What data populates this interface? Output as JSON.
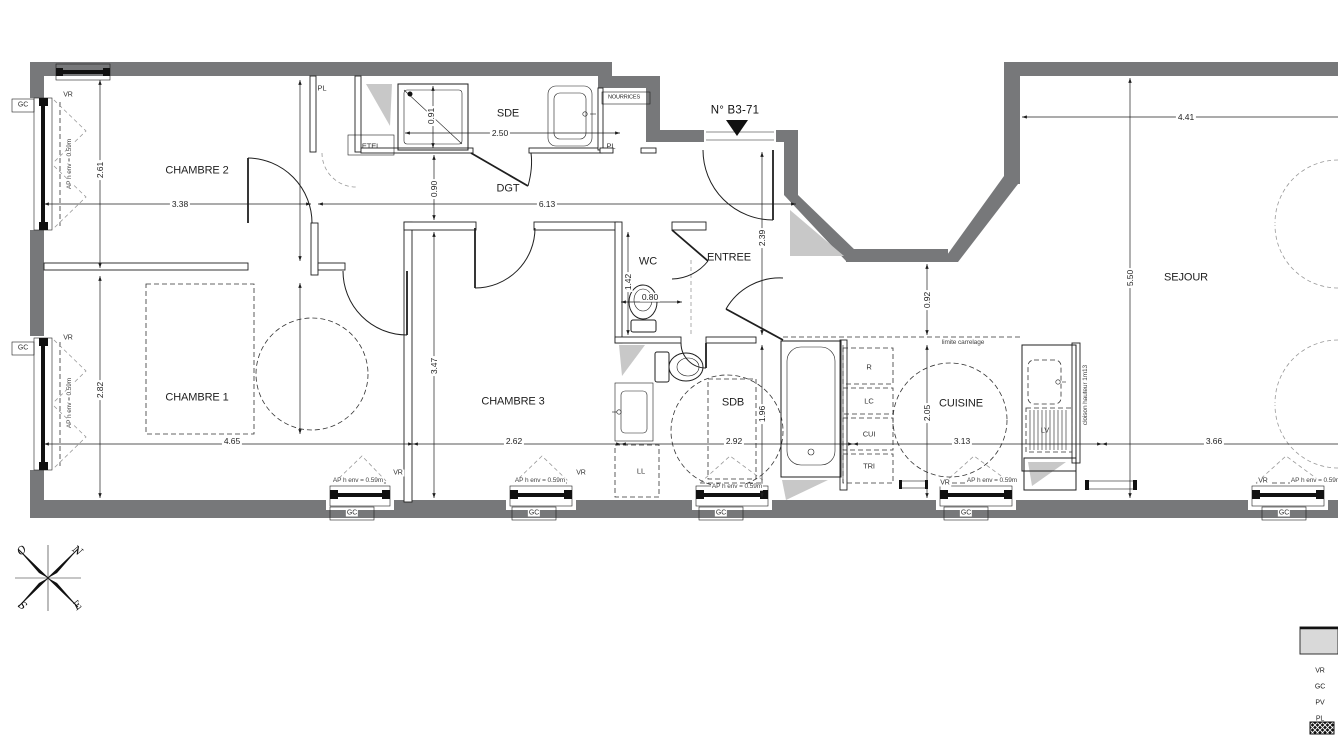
{
  "title": "N° B3-71",
  "rooms": {
    "chambre2": "CHAMBRE 2",
    "sde": "SDE",
    "dgt": "DGT",
    "wc": "WC",
    "entree": "ENTREE",
    "chambre1": "CHAMBRE 1",
    "chambre3": "CHAMBRE 3",
    "sdb": "SDB",
    "cuisine": "CUISINE",
    "sejour": "SEJOUR"
  },
  "dims": {
    "chambre2_w": "3.38",
    "chambre2_h": "2.61",
    "sde_w": "2.50",
    "shower_w": "0.91",
    "dgt_w": "0.90",
    "dgt_l": "6.13",
    "entree_h": "2.39",
    "wc_h": "1.42",
    "wc_w": "0.80",
    "recess_h": "0.92",
    "sejour_top_w": "4.41",
    "sejour_h": "5.50",
    "chambre1_h": "2.82",
    "chambre1_w": "4.65",
    "chambre3_h": "3.47",
    "chambre3_w": "2.62",
    "sdb_w": "2.92",
    "sdb_h": "1.96",
    "cuisine_h": "2.05",
    "cuisine_w": "3.13",
    "sejour_w": "3.66"
  },
  "annotations": {
    "pl": "PL",
    "etel": "ETEL",
    "nourrices": "NOURRICES",
    "limite_carrelage": "limite carrelage",
    "cloison": "cloison hauteur 1m13",
    "r": "R",
    "lc": "LC",
    "cui": "CUI",
    "tri": "TRI",
    "ll": "LL",
    "lv": "LV"
  },
  "windows": {
    "vr": "VR",
    "gc": "GC",
    "ap": "AP h env = 0.59m"
  },
  "legend": {
    "vr": "VR",
    "gc": "GC",
    "pv": "PV",
    "pl": "PL"
  },
  "compass": {
    "n": "N",
    "e": "E",
    "s": "S",
    "o": "O"
  },
  "colors": {
    "wall": "#77787a",
    "line": "#1f1f1f",
    "shade": "#c8c8c8",
    "dash_gray": "#999999",
    "legend_gray": "#d9d9d9"
  }
}
